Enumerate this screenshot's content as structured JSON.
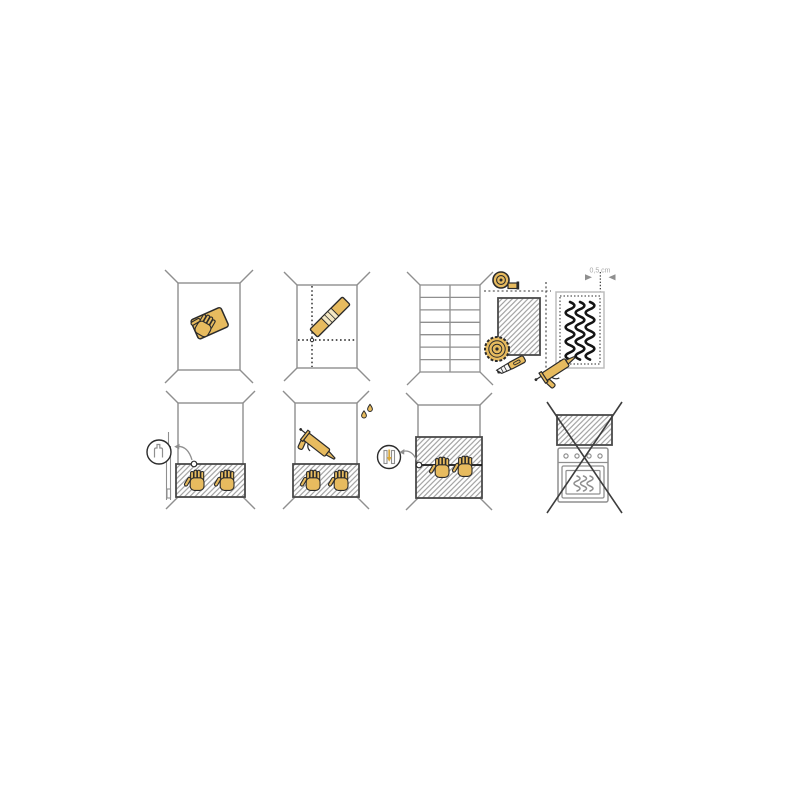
{
  "canvas": {
    "width": 800,
    "height": 800,
    "background": "#ffffff"
  },
  "palette": {
    "accent_tan": "#e7bb5f",
    "accent_tan_dark": "#d9a83c",
    "outline_dark": "#2b2b2b",
    "ink_black": "#141414",
    "wall_gray": "#8f8f8f",
    "hatch_gray": "#9e9e9e",
    "panel_border_gray": "#4a4a4a",
    "light_border_gray": "#bdbdbd",
    "label_gray": "#a9a9a9",
    "cross_gray": "#3d3d3d"
  },
  "labels": {
    "gap_measurement": "0,5 cm"
  },
  "steps": [
    {
      "position": "row1-col1",
      "name": "clean-wall",
      "icons": [
        "wall-outline",
        "hand-wiping-cloth-icon"
      ]
    },
    {
      "position": "row1-col2",
      "name": "mark-guide-lines",
      "icons": [
        "wall-outline",
        "vertical-dotted-guide-line",
        "horizontal-dotted-guide-line",
        "spirit-level-icon"
      ]
    },
    {
      "position": "row1-col3",
      "name": "measure-and-cut-panel",
      "icons": [
        "tiled-wall-outline",
        "measuring-tape-icon",
        "hatched-panel",
        "cut-guide-dashed-lines",
        "circular-saw-blade-icon",
        "utility-knife-icon"
      ]
    },
    {
      "position": "row1-col4",
      "name": "apply-adhesive-to-panel-back",
      "label": "0,5 cm",
      "icons": [
        "panel-back-outline",
        "adhesive-bead-squiggles",
        "caulking-gun-icon",
        "gap-dimension-arrows"
      ]
    },
    {
      "position": "row2-col1",
      "name": "mount-first-panel",
      "icons": [
        "wall-outline",
        "hatched-panel",
        "hand-icon",
        "hand-icon",
        "edge-profile-strip",
        "magnifier-detail-circle",
        "callout-arrow"
      ]
    },
    {
      "position": "row2-col2",
      "name": "seal-panel-top-edge",
      "icons": [
        "wall-outline",
        "hatched-panel",
        "hand-icon",
        "hand-icon",
        "caulking-gun-icon",
        "water-drop-icon",
        "water-drop-icon"
      ]
    },
    {
      "position": "row2-col3",
      "name": "join-second-panel",
      "icons": [
        "wall-outline",
        "hatched-panels-with-seam",
        "hand-icon",
        "hand-icon",
        "joint-profile-detail-circle",
        "callout-arrow"
      ]
    },
    {
      "position": "row2-col4",
      "name": "do-not-install-above-oven",
      "icons": [
        "hatched-panel",
        "oven-icon",
        "prohibition-cross"
      ]
    }
  ]
}
